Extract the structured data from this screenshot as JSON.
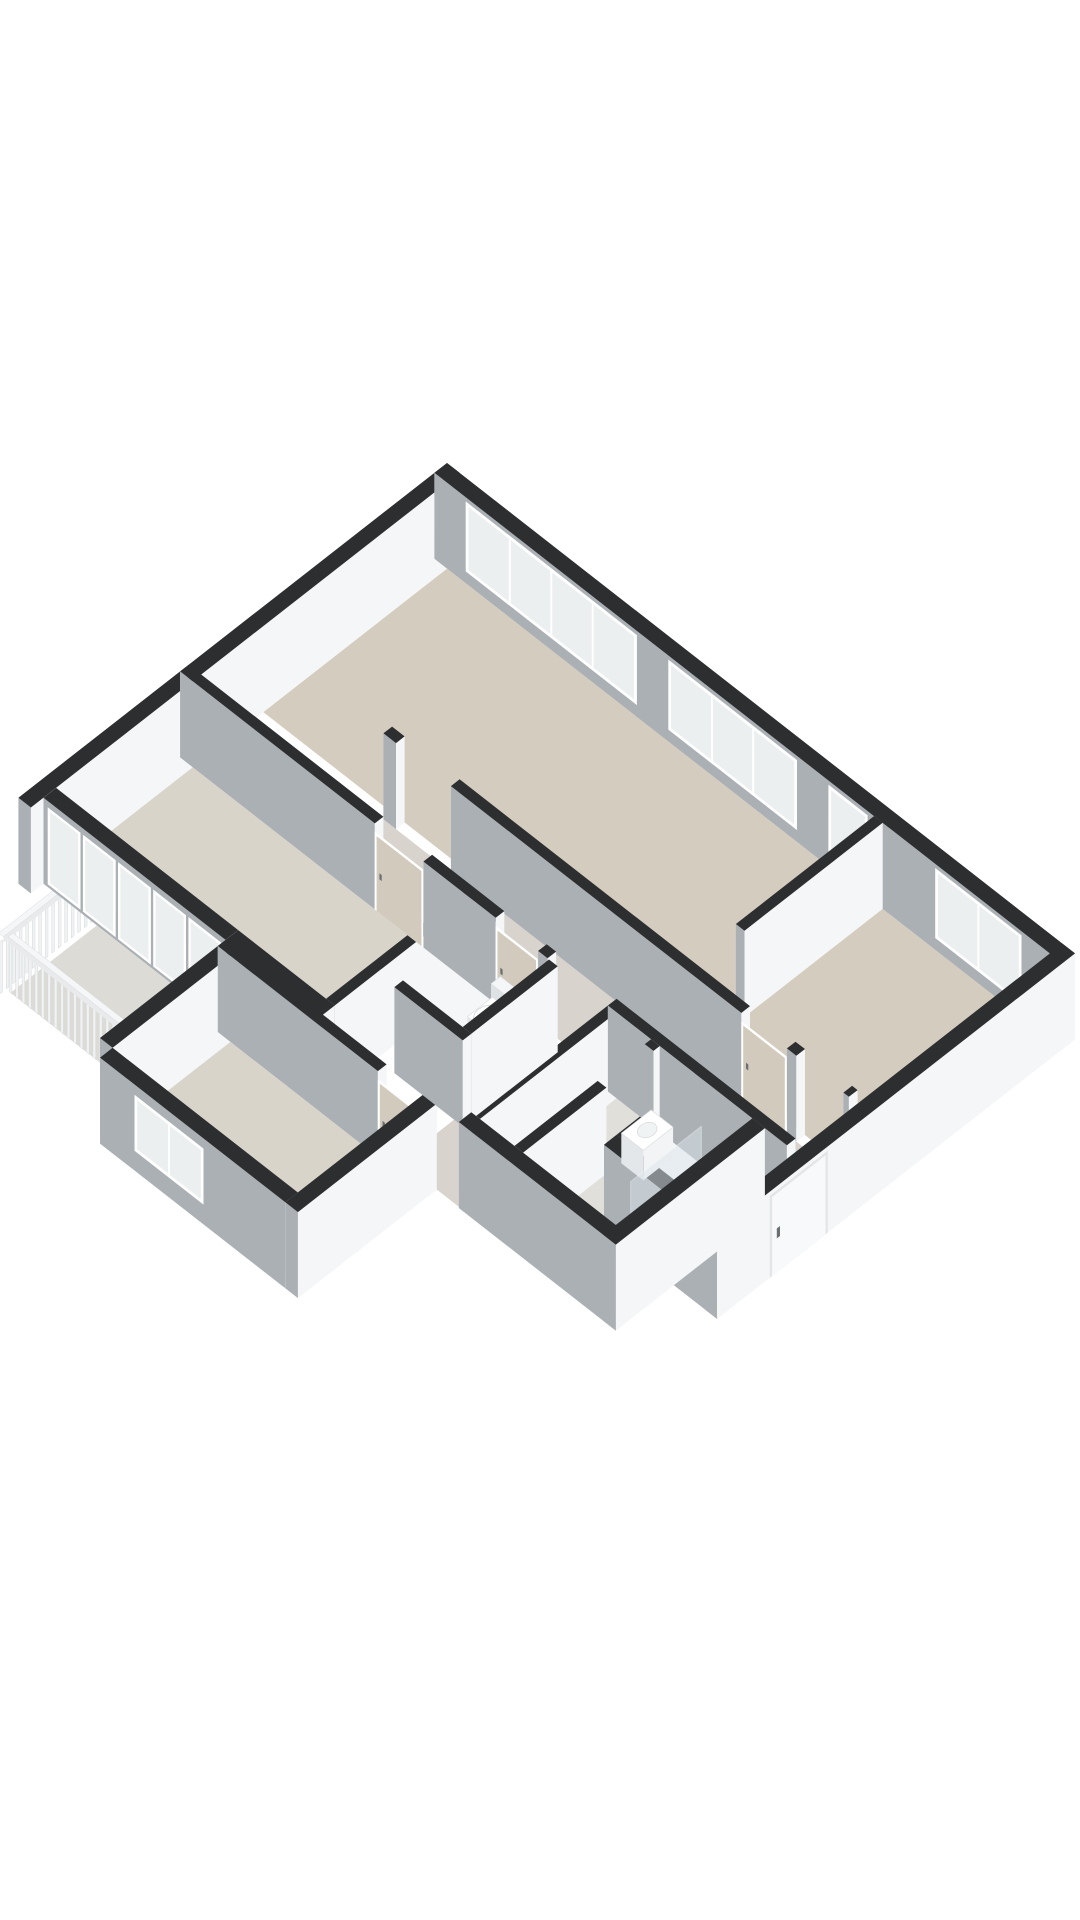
{
  "meta": {
    "description": "3D isometric dollhouse-style floor plan of an apartment, no labels, white background",
    "background": "#ffffff"
  },
  "palette": {
    "wallTop": "#2d2e30",
    "faceLight": "#f4f6f7",
    "faceMid": "#e8eaeb",
    "faceShade": "#abb0b5",
    "faceShadeDark": "#9ba1a6",
    "floorMain": "#d4cdbf",
    "floorBeige2": "#d9d4c9",
    "floorHall": "#d8d4cd",
    "floorPale": "#e1dfd9",
    "floorBalcony": "#dcdbd6",
    "glass": "#eceff0",
    "frame": "#ffffff",
    "glazeFrame": "#ced3d6",
    "doorLeaf": "#d2cabc",
    "doorWhite": "#f8f9fa",
    "handle": "#6a6f73",
    "woodTop": "#dccfba",
    "woodA": "#e7ddcb",
    "woodSW": "#cfc2ab",
    "tubInner": "#fafbfc",
    "railSlat": "#f0f2f3",
    "railEdge": "#d6d9db",
    "screenGlass": "#dce6eb"
  },
  "iso": {
    "ox": 447,
    "oy": 549,
    "kx": 0.785,
    "ky": 0.613,
    "wallH": 86
  },
  "rooms": [
    {
      "id": "living-room",
      "floor": "floorMain"
    },
    {
      "id": "bedroom-right",
      "floor": "floorMain"
    },
    {
      "id": "bedroom-top-left",
      "floor": "floorBeige2"
    },
    {
      "id": "bedroom-bottom-left",
      "floor": "floorBeige2"
    },
    {
      "id": "hall",
      "floor": "floorHall"
    },
    {
      "id": "entry",
      "floor": "floorHall"
    },
    {
      "id": "wc",
      "floor": "floorPale"
    },
    {
      "id": "bathroom",
      "floor": "floorPale"
    },
    {
      "id": "balcony",
      "floor": "floorBalcony"
    }
  ],
  "floors": [
    {
      "id": "floor-living-room",
      "rect": [
        16,
        16,
        560,
        250
      ],
      "color": "floorMain"
    },
    {
      "id": "floor-bedroom-right",
      "rect": [
        571,
        16,
        784,
        250
      ],
      "color": "floorMain"
    },
    {
      "id": "floor-hall",
      "rect": [
        180,
        261,
        773,
        329
      ],
      "color": "floorHall"
    },
    {
      "id": "floor-entry",
      "rect": [
        656,
        261,
        784,
        440
      ],
      "color": "floorHall"
    },
    {
      "id": "floor-hall-leg",
      "rect": [
        470,
        340,
        545,
        529
      ],
      "color": "floorHall"
    },
    {
      "id": "floor-closet",
      "rect": [
        545,
        340,
        600,
        514
      ],
      "color": "floorPale"
    },
    {
      "id": "floor-bedroom-top-left",
      "rect": [
        16,
        340,
        360,
        514
      ],
      "color": "floorBeige2"
    },
    {
      "id": "floor-wc",
      "rect": [
        405,
        340,
        470,
        450
      ],
      "color": "floorPale"
    },
    {
      "id": "floor-bathroom",
      "rect": [
        611,
        340,
        729,
        514
      ],
      "color": "floorPale"
    },
    {
      "id": "floor-bedroom-bottom-left",
      "rect": [
        264,
        540,
        500,
        690
      ],
      "color": "floorBeige2"
    },
    {
      "id": "floor-balcony",
      "rect": [
        84,
        530,
        240,
        640
      ],
      "color": "floorBalcony"
    }
  ],
  "walls": [
    {
      "id": "ne-exterior-wall",
      "dir": "a",
      "s0": 0,
      "s1": 800,
      "pos": 0,
      "t": 16,
      "windows": [
        {
          "s0": 40,
          "s1": 258,
          "panes": 4
        },
        {
          "s0": 298,
          "s1": 462,
          "panes": 3
        },
        {
          "s0": 502,
          "s1": 552,
          "panes": 1
        },
        {
          "s0": 638,
          "s1": 748,
          "panes": 2
        }
      ]
    },
    {
      "id": "hall-north-wall",
      "dir": "a",
      "s0": 180,
      "s1": 773,
      "pos": 250,
      "t": 11,
      "openings": [
        {
          "type": "gap",
          "s0": 196,
          "s1": 266
        },
        {
          "type": "door",
          "s0": 636,
          "s1": 694
        },
        {
          "type": "gap",
          "s0": 706,
          "s1": 766
        }
      ]
    },
    {
      "id": "hall-south-wall",
      "dir": "a",
      "s0": 0,
      "s1": 773,
      "pos": 329,
      "t": 11,
      "openings": [
        {
          "type": "door",
          "s0": 248,
          "s1": 310
        },
        {
          "type": "door",
          "s0": 402,
          "s1": 456
        },
        {
          "type": "gap",
          "s0": 468,
          "s1": 545
        }
      ]
    },
    {
      "id": "wc-south-wall",
      "dir": "a",
      "s0": 394,
      "s1": 481,
      "pos": 450,
      "t": 11,
      "front": true
    },
    {
      "id": "balcony-glazed-wall",
      "dir": "a",
      "s0": 16,
      "s1": 248,
      "pos": 514,
      "t": 16,
      "glazed": true
    },
    {
      "id": "topleft-sw-wall",
      "dir": "a",
      "s0": 248,
      "s1": 371,
      "pos": 514,
      "t": 16
    },
    {
      "id": "b3-ne-wall",
      "dir": "a",
      "s0": 248,
      "s1": 511,
      "pos": 529,
      "t": 11,
      "openings": [
        {
          "type": "door",
          "s0": 452,
          "s1": 506
        }
      ]
    },
    {
      "id": "b3-sw-wall",
      "dir": "a",
      "s0": 264,
      "s1": 500,
      "pos": 690,
      "t": 16,
      "windows": [
        {
          "s0": 308,
          "s1": 396,
          "panes": 2,
          "z0": 20,
          "z1": 76
        }
      ]
    },
    {
      "id": "bathroom-sw-wall",
      "dir": "a",
      "s0": 545,
      "s1": 745,
      "pos": 514,
      "t": 16,
      "front": true
    },
    {
      "id": "entry-sw-wall",
      "dir": "a",
      "s0": 656,
      "s1": 800,
      "pos": 440,
      "t": 16
    },
    {
      "id": "nw-exterior-wall",
      "dir": "b",
      "s0": 0,
      "s1": 546,
      "pos": 0,
      "t": 16
    },
    {
      "id": "living-partition",
      "dir": "b",
      "s0": 16,
      "s1": 250,
      "pos": 560,
      "t": 11,
      "openings": [
        {
          "type": "gap",
          "s0": 192,
          "s1": 250
        }
      ]
    },
    {
      "id": "se-exterior-wall",
      "dir": "b",
      "s0": 0,
      "s1": 456,
      "pos": 784,
      "t": 16,
      "frontDoor": {
        "s0": 318,
        "s1": 386
      }
    },
    {
      "id": "topleft-se-wall",
      "dir": "b",
      "s0": 340,
      "s1": 514,
      "pos": 360,
      "t": 11
    },
    {
      "id": "wc-west-wall",
      "dir": "b",
      "s0": 340,
      "s1": 450,
      "pos": 394,
      "t": 11
    },
    {
      "id": "wc-east-wall",
      "dir": "b",
      "s0": 340,
      "s1": 450,
      "pos": 470,
      "t": 11,
      "front": true
    },
    {
      "id": "leg-east-wall",
      "dir": "b",
      "s0": 340,
      "s1": 514,
      "pos": 545,
      "t": 11
    },
    {
      "id": "bathroom-nw-wall",
      "dir": "b",
      "s0": 340,
      "s1": 514,
      "pos": 600,
      "t": 11,
      "openings": [
        {
          "type": "gap",
          "s0": 348,
          "s1": 408
        }
      ]
    },
    {
      "id": "bathroom-se-wall",
      "dir": "b",
      "s0": 340,
      "s1": 530,
      "pos": 729,
      "t": 16,
      "front": true
    },
    {
      "id": "entry-west-wall",
      "dir": "b",
      "s0": 340,
      "s1": 440,
      "pos": 656,
      "t": 11
    },
    {
      "id": "b3-nw-wall",
      "dir": "b",
      "s0": 529,
      "s1": 690,
      "pos": 248,
      "t": 16
    },
    {
      "id": "b3-se-wall",
      "dir": "b",
      "s0": 529,
      "s1": 706,
      "pos": 500,
      "t": 16
    }
  ],
  "railings": [
    {
      "id": "balcony-railing-sw",
      "dir": "a",
      "s0": 84,
      "s1": 240,
      "pos": 640,
      "h": 52
    },
    {
      "id": "balcony-railing-nw",
      "dir": "b",
      "s0": 530,
      "s1": 646,
      "pos": 78,
      "h": 52
    }
  ],
  "fixtures": [
    {
      "id": "toilet",
      "kind": "toilet",
      "tank": [
        412,
        344,
        442,
        356,
        36
      ],
      "body": [
        414,
        356,
        440,
        388,
        24
      ]
    },
    {
      "id": "washbasin",
      "kind": "basin",
      "box": [
        612,
        352,
        640,
        390,
        30
      ]
    },
    {
      "id": "shower-screen",
      "kind": "screen",
      "quad": [
        358,
        448,
        682,
        60
      ]
    },
    {
      "id": "bathtub",
      "kind": "tub",
      "platform": [
        683,
        358,
        729,
        505,
        26
      ],
      "inner": [
        689,
        366,
        723,
        497
      ]
    }
  ]
}
